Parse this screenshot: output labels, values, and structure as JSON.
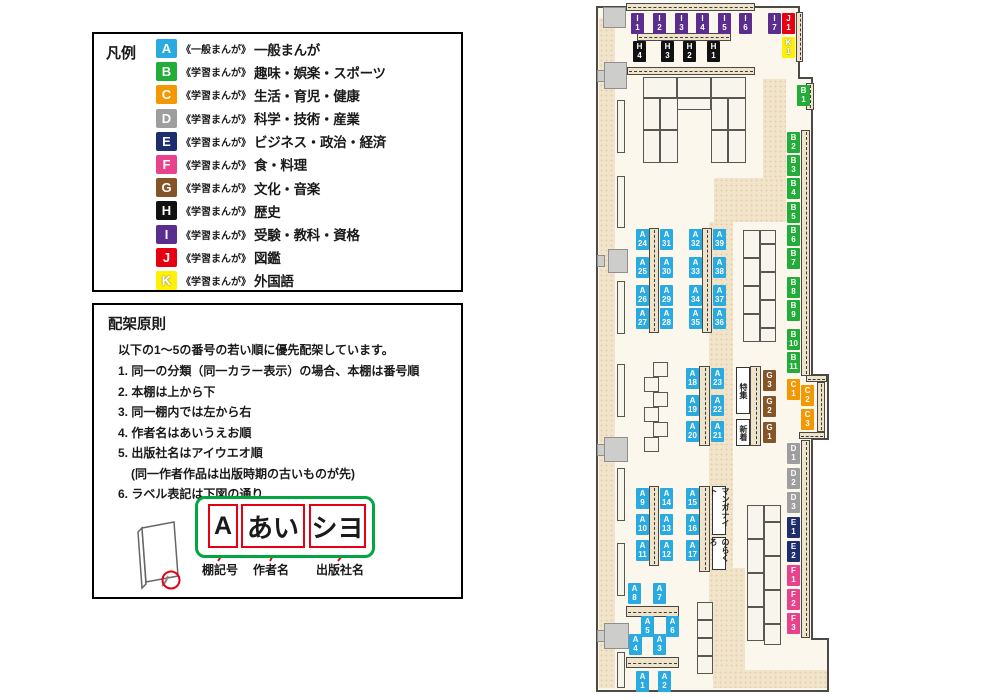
{
  "colors": {
    "A": "#29ABE2",
    "B": "#22AC38",
    "C": "#F39800",
    "D": "#9E9E9F",
    "E": "#1D2E6E",
    "F": "#E8428C",
    "G": "#855427",
    "H": "#111111",
    "I": "#5B2D8E",
    "J": "#E60012",
    "K": "#FFF100"
  },
  "legend": {
    "title": "凡例",
    "items": [
      {
        "code": "A",
        "series": "《一般まんが》",
        "category": "一般まんが"
      },
      {
        "code": "B",
        "series": "《学習まんが》",
        "category": "趣味・娯楽・スポーツ"
      },
      {
        "code": "C",
        "series": "《学習まんが》",
        "category": "生活・育児・健康"
      },
      {
        "code": "D",
        "series": "《学習まんが》",
        "category": "科学・技術・産業"
      },
      {
        "code": "E",
        "series": "《学習まんが》",
        "category": "ビジネス・政治・経済"
      },
      {
        "code": "F",
        "series": "《学習まんが》",
        "category": "食・料理"
      },
      {
        "code": "G",
        "series": "《学習まんが》",
        "category": "文化・音楽"
      },
      {
        "code": "H",
        "series": "《学習まんが》",
        "category": "歴史"
      },
      {
        "code": "I",
        "series": "《学習まんが》",
        "category": "受験・教科・資格"
      },
      {
        "code": "J",
        "series": "《学習まんが》",
        "category": "図鑑"
      },
      {
        "code": "K",
        "series": "《学習まんが》",
        "category": "外国語"
      }
    ]
  },
  "principles": {
    "title": "配架原則",
    "intro": "以下の1～5の番号の若い順に優先配架しています。",
    "items": [
      {
        "text": "1. 同一の分類（同一カラー表示）の場合、本棚は番号順",
        "indent": false
      },
      {
        "text": "2. 本棚は上から下",
        "indent": false
      },
      {
        "text": "3. 同一棚内では左から右",
        "indent": false
      },
      {
        "text": "4. 作者名はあいうえお順",
        "indent": false
      },
      {
        "text": "5. 出版社名はアイウエオ順",
        "indent": false
      },
      {
        "text": "(同一作者作品は出版時期の古いものが先)",
        "indent": true
      },
      {
        "text": "6. ラベル表記は下図の通り",
        "indent": false
      }
    ],
    "diagram": {
      "boxes": [
        "A",
        "あい",
        "シヨ"
      ],
      "labels": [
        "棚記号",
        "作者名",
        "出版社名"
      ]
    }
  },
  "map": {
    "areas": [
      {
        "t": "特集",
        "x": 736,
        "y": 367,
        "w": 14,
        "h": 47
      },
      {
        "t": "新着",
        "x": 736,
        "y": 419,
        "w": 14,
        "h": 27
      },
      {
        "t": "マンガナイト",
        "x": 712,
        "y": 486,
        "w": 14,
        "h": 49
      },
      {
        "t": "のらくろ",
        "x": 712,
        "y": 537,
        "w": 14,
        "h": 33
      }
    ],
    "labels": [
      {
        "t": "I1",
        "x": 631,
        "y": 13
      },
      {
        "t": "I2",
        "x": 653,
        "y": 13
      },
      {
        "t": "I3",
        "x": 675,
        "y": 13
      },
      {
        "t": "I4",
        "x": 696,
        "y": 13
      },
      {
        "t": "I5",
        "x": 718,
        "y": 13
      },
      {
        "t": "I6",
        "x": 739,
        "y": 13
      },
      {
        "t": "I7",
        "x": 768,
        "y": 13
      },
      {
        "t": "J1",
        "x": 782,
        "y": 13
      },
      {
        "t": "K1",
        "x": 782,
        "y": 37
      },
      {
        "t": "H4",
        "x": 633,
        "y": 41
      },
      {
        "t": "H3",
        "x": 661,
        "y": 41
      },
      {
        "t": "H2",
        "x": 683,
        "y": 41
      },
      {
        "t": "H1",
        "x": 707,
        "y": 41
      },
      {
        "t": "B1",
        "x": 797,
        "y": 85
      },
      {
        "t": "B2",
        "x": 787,
        "y": 132
      },
      {
        "t": "B3",
        "x": 787,
        "y": 155
      },
      {
        "t": "B4",
        "x": 787,
        "y": 178
      },
      {
        "t": "B5",
        "x": 787,
        "y": 202
      },
      {
        "t": "B6",
        "x": 787,
        "y": 225
      },
      {
        "t": "B7",
        "x": 787,
        "y": 248
      },
      {
        "t": "B8",
        "x": 787,
        "y": 277
      },
      {
        "t": "B9",
        "x": 787,
        "y": 300
      },
      {
        "t": "B10",
        "x": 787,
        "y": 329
      },
      {
        "t": "B11",
        "x": 787,
        "y": 352
      },
      {
        "t": "C1",
        "x": 787,
        "y": 379
      },
      {
        "t": "C2",
        "x": 801,
        "y": 385
      },
      {
        "t": "C3",
        "x": 801,
        "y": 409
      },
      {
        "t": "D1",
        "x": 787,
        "y": 443
      },
      {
        "t": "D2",
        "x": 787,
        "y": 468
      },
      {
        "t": "D3",
        "x": 787,
        "y": 492
      },
      {
        "t": "E1",
        "x": 787,
        "y": 517
      },
      {
        "t": "E2",
        "x": 787,
        "y": 541
      },
      {
        "t": "F1",
        "x": 787,
        "y": 565
      },
      {
        "t": "F2",
        "x": 787,
        "y": 589
      },
      {
        "t": "F3",
        "x": 787,
        "y": 613
      },
      {
        "t": "G3",
        "x": 763,
        "y": 370
      },
      {
        "t": "G2",
        "x": 763,
        "y": 396
      },
      {
        "t": "G1",
        "x": 763,
        "y": 422
      },
      {
        "t": "A24",
        "x": 636,
        "y": 229
      },
      {
        "t": "A25",
        "x": 636,
        "y": 257
      },
      {
        "t": "A26",
        "x": 636,
        "y": 285
      },
      {
        "t": "A27",
        "x": 636,
        "y": 308
      },
      {
        "t": "A31",
        "x": 660,
        "y": 229
      },
      {
        "t": "A30",
        "x": 660,
        "y": 257
      },
      {
        "t": "A29",
        "x": 660,
        "y": 285
      },
      {
        "t": "A28",
        "x": 660,
        "y": 308
      },
      {
        "t": "A32",
        "x": 689,
        "y": 229
      },
      {
        "t": "A33",
        "x": 689,
        "y": 257
      },
      {
        "t": "A34",
        "x": 689,
        "y": 285
      },
      {
        "t": "A35",
        "x": 689,
        "y": 308
      },
      {
        "t": "A39",
        "x": 713,
        "y": 229
      },
      {
        "t": "A38",
        "x": 713,
        "y": 257
      },
      {
        "t": "A37",
        "x": 713,
        "y": 285
      },
      {
        "t": "A36",
        "x": 713,
        "y": 308
      },
      {
        "t": "A18",
        "x": 686,
        "y": 368
      },
      {
        "t": "A19",
        "x": 686,
        "y": 395
      },
      {
        "t": "A20",
        "x": 686,
        "y": 421
      },
      {
        "t": "A23",
        "x": 711,
        "y": 368
      },
      {
        "t": "A22",
        "x": 711,
        "y": 395
      },
      {
        "t": "A21",
        "x": 711,
        "y": 421
      },
      {
        "t": "A9",
        "x": 636,
        "y": 488
      },
      {
        "t": "A10",
        "x": 636,
        "y": 514
      },
      {
        "t": "A11",
        "x": 636,
        "y": 540
      },
      {
        "t": "A14",
        "x": 660,
        "y": 488
      },
      {
        "t": "A13",
        "x": 660,
        "y": 514
      },
      {
        "t": "A12",
        "x": 660,
        "y": 540
      },
      {
        "t": "A15",
        "x": 686,
        "y": 488
      },
      {
        "t": "A16",
        "x": 686,
        "y": 514
      },
      {
        "t": "A17",
        "x": 686,
        "y": 540
      },
      {
        "t": "A8",
        "x": 628,
        "y": 583
      },
      {
        "t": "A7",
        "x": 653,
        "y": 583
      },
      {
        "t": "A5",
        "x": 641,
        "y": 616
      },
      {
        "t": "A6",
        "x": 666,
        "y": 616
      },
      {
        "t": "A4",
        "x": 629,
        "y": 634
      },
      {
        "t": "A3",
        "x": 653,
        "y": 634
      },
      {
        "t": "A1",
        "x": 636,
        "y": 671
      },
      {
        "t": "A2",
        "x": 658,
        "y": 671
      }
    ]
  }
}
